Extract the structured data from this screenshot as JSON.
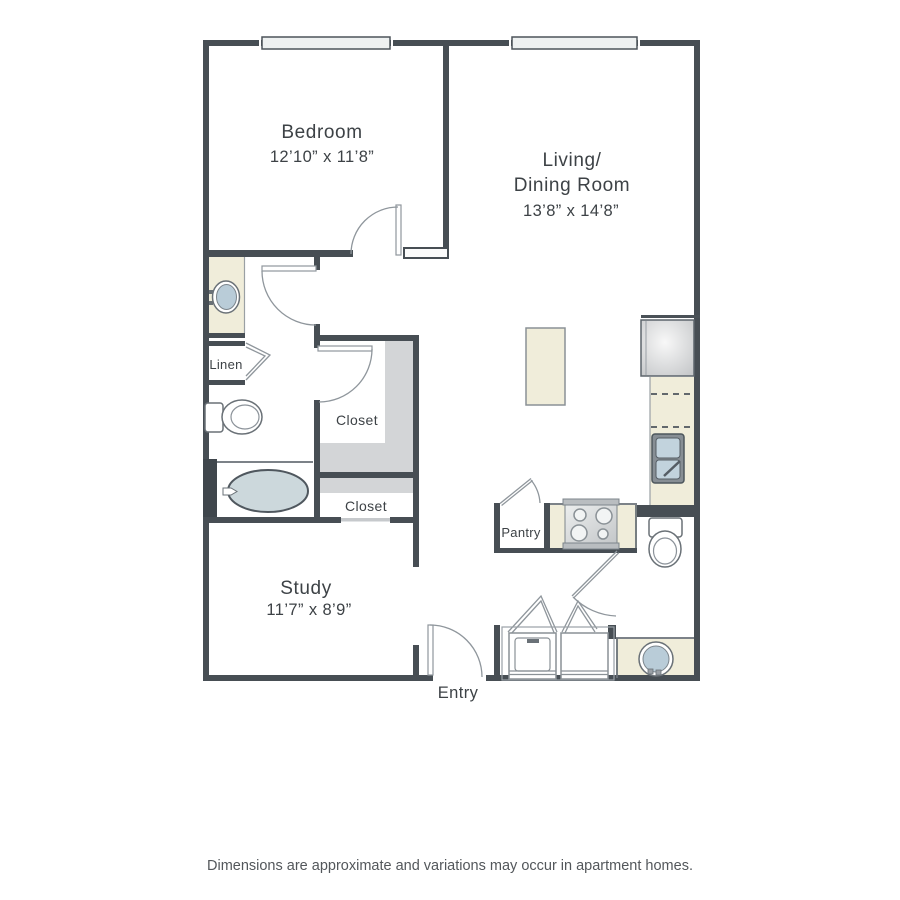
{
  "floorplan": {
    "rooms": {
      "bedroom": {
        "name": "Bedroom",
        "dimensions": "12’10” x 11’8”"
      },
      "living_dining": {
        "name_line1": "Living/",
        "name_line2": "Dining Room",
        "dimensions": "13’8” x 14’8”"
      },
      "study": {
        "name": "Study",
        "dimensions": "11’7” x 8’9”"
      }
    },
    "labels": {
      "linen": "Linen",
      "closet_upper": "Closet",
      "closet_lower": "Closet",
      "pantry": "Pantry",
      "entry": "Entry"
    },
    "fixtures": [
      "bathtub",
      "toilet",
      "vanity-sink",
      "kitchen-sink",
      "stove",
      "refrigerator",
      "kitchen-island",
      "washer",
      "dryer",
      "round-sink",
      "windows"
    ],
    "colors": {
      "wall": "#474e54",
      "counter_cream": "#f0edda",
      "closet_gray": "#d3d5d7",
      "fixture_blue": "#b9ccd8",
      "tub_blue": "#ccd8dc",
      "text": "#3d4246"
    },
    "footer": {
      "disclaimer": "Dimensions are approximate and variations may occur in apartment homes."
    }
  }
}
